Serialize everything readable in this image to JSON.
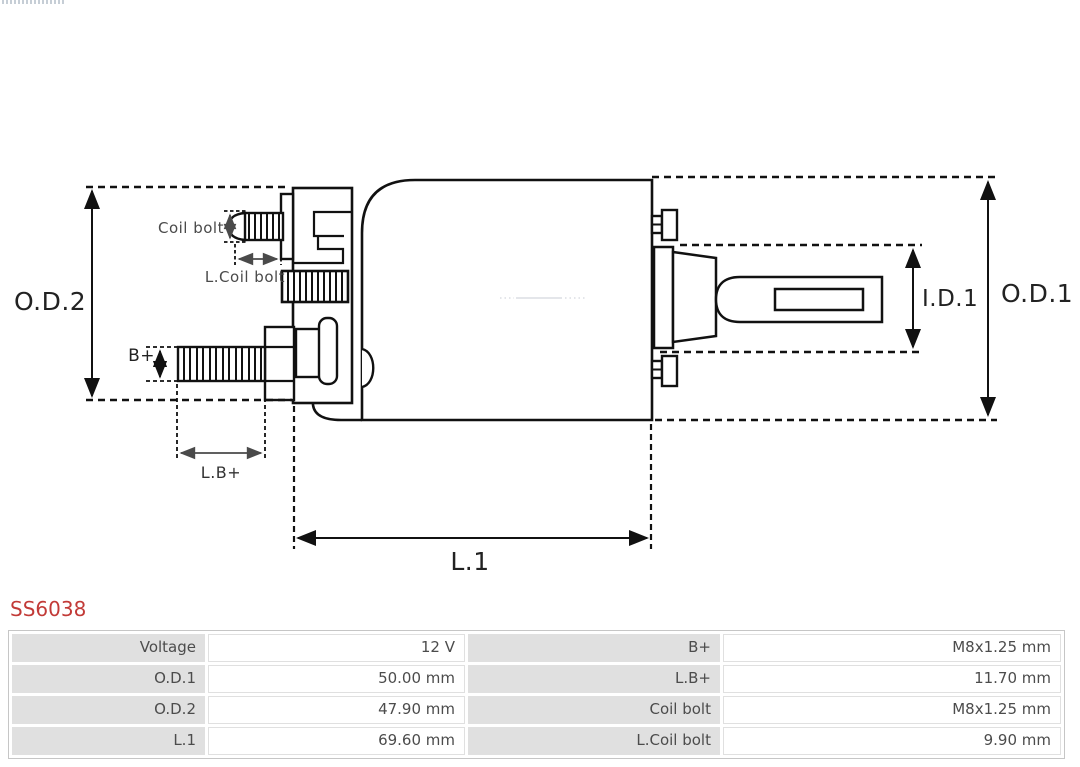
{
  "part": {
    "number": "SS6038"
  },
  "diagram": {
    "labels": {
      "od2": "O.D.2",
      "od1": "O.D.1",
      "id1": "I.D.1",
      "l1": "L.1",
      "b_plus": "B+",
      "l_b_plus": "L.B+",
      "coil_bolt": "Coil bolt",
      "l_coil_bolt": "L.Coil bolt"
    }
  },
  "spec_table": {
    "rows": [
      {
        "label1": "Voltage",
        "value1": "12 V",
        "label2": "B+",
        "value2": "M8x1.25 mm"
      },
      {
        "label1": "O.D.1",
        "value1": "50.00 mm",
        "label2": "L.B+",
        "value2": "11.70 mm"
      },
      {
        "label1": "O.D.2",
        "value1": "47.90 mm",
        "label2": "Coil bolt",
        "value2": "M8x1.25 mm"
      },
      {
        "label1": "L.1",
        "value1": "69.60 mm",
        "label2": "L.Coil bolt",
        "value2": "9.90 mm"
      }
    ]
  },
  "colors": {
    "part_number_red": "#c23a37",
    "drawing_line": "#111111",
    "dim_label_dark": "#222222",
    "dim_label_gray": "#4a4a4a",
    "table_label_bg": "#e0e0e0",
    "table_border": "#c6c6c6",
    "table_text": "#4c4c4c"
  }
}
